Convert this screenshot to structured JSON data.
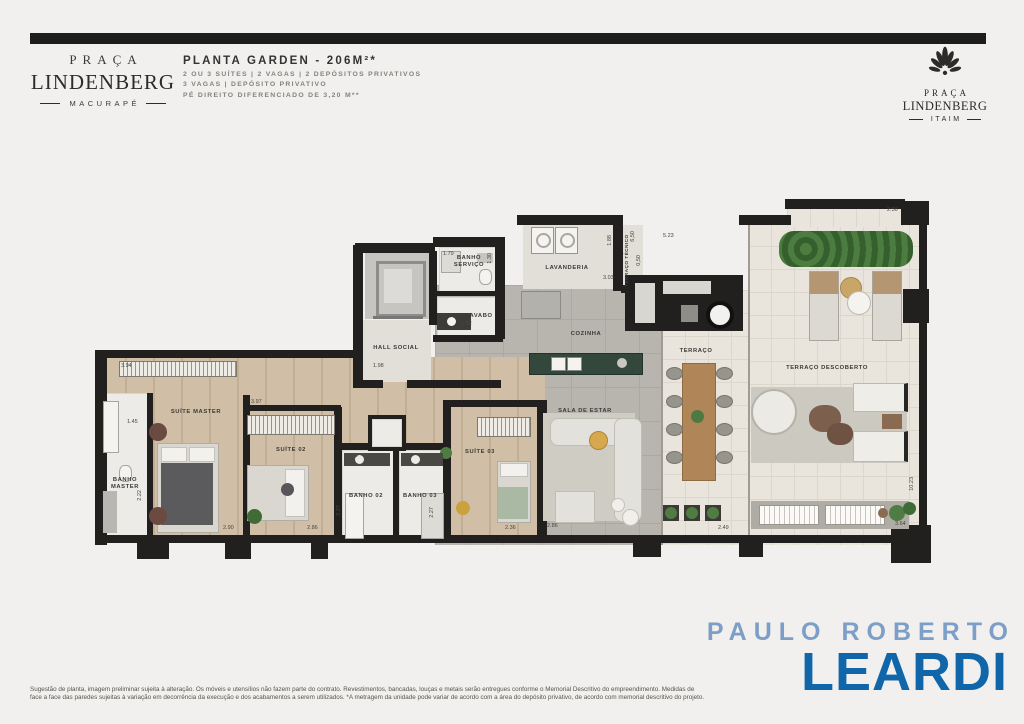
{
  "header": {
    "brand_left": {
      "top": "PRAÇA",
      "name": "LINDENBERG",
      "sub": "MACURAPÉ"
    },
    "plan_info": {
      "title": "PLANTA GARDEN - 206M²*",
      "line1": "2 OU 3 SUÍTES | 2 VAGAS | 2 DEPÓSITOS PRIVATIVOS",
      "line2": "3 VAGAS | DEPÓSITO PRIVATIVO",
      "line3": "PÉ DIREITO DIFERENCIADO DE 3,20 M**"
    },
    "brand_right": {
      "top": "PRAÇA",
      "name": "LINDENBERG",
      "sub": "ITAIM"
    }
  },
  "floorplan": {
    "rooms": {
      "suite_master": "SUÍTE MASTER",
      "banho_master": "BANHO MASTER",
      "suite_02": "SUÍTE 02",
      "banho_02": "BANHO 02",
      "banho_03": "BANHO 03",
      "suite_03": "SUÍTE 03",
      "hall_social": "HALL SOCIAL",
      "banho_servico": "BANHO SERVIÇO",
      "lavabo": "LAVABO",
      "lavanderia": "LAVANDERIA",
      "cozinha": "COZINHA",
      "sala_de_estar": "SALA DE ESTAR",
      "terraco": "TERRAÇO",
      "terraco_descoberto": "TERRAÇO DESCOBERTO",
      "terraco_tecnico": "TERRAÇO TÉCNICO"
    },
    "dims": {
      "suite_master_w": "3.94",
      "banho_master_w": "1.45",
      "banho_master_d": "2.22",
      "suite_master_bed": "2.90",
      "suite_02_w": "3.97",
      "suite_02_bed": "2.86",
      "banho_02_w": "1.45",
      "banho_02_d": "2.27",
      "banho_03_w": "1.49",
      "banho_03_d": "2.27",
      "suite_03_bed": "2.36",
      "hall_w": "1.98",
      "banho_servico_w": "1.79",
      "banho_servico_d": "1.30",
      "lavabo_w": "1.82",
      "lavanderia_w": "3.03",
      "lavanderia_d": "1.88",
      "tecnico_l": "6,50",
      "tecnico_d": "0,50",
      "terraco_top": "5.23",
      "desc_top": "2.56",
      "desc_right": "10.23",
      "desc_bottom": "3.64",
      "terraco_bottom": "2.49",
      "sala_bottom": "2.86"
    }
  },
  "footer": {
    "disclaimer": [
      "Sugestão de planta, imagem preliminar sujeita à alteração. Os móveis e utensílios não fazem parte do contrato. Revestimentos, bancadas, louças e metais serão entregues conforme o Memorial Descritivo do empreendimento. Medidas de",
      "face a face das paredes sujeitas à variação em decorrência da execução e dos acabamentos a serem utilizados. *A metragem da unidade pode variar de acordo com a área do depósito privativo, de acordo com memorial descritivo do projeto."
    ],
    "realtor": {
      "top": "PAULO ROBERTO",
      "name": "LEARDI"
    }
  },
  "colors": {
    "wall": "#21201e",
    "leardi_blue": "#1166a9",
    "leardi_light_blue": "#7d9fc7",
    "island_green": "#33473c",
    "plant_green": "#4e7c42",
    "wood_floor": "#d0bfa6"
  }
}
